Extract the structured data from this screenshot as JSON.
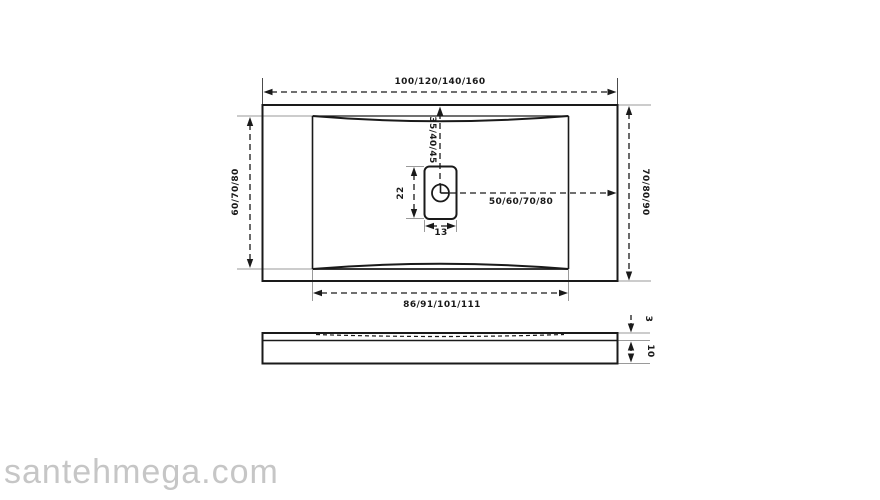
{
  "drawing": {
    "type": "technical-drawing",
    "subject": "rectangular shower tray with central drain, top view and side section",
    "colors": {
      "line": "#1a1a1a",
      "extension_line": "#9a9a9a",
      "watermark": "#c6c6c6",
      "background": "#ffffff"
    },
    "top_view": {
      "overall_width": "100/120/140/160",
      "overall_depth_left": "60/70/80",
      "overall_depth_right": "70/80/90",
      "basin_width": "86/91/101/111",
      "drain_offset_from_top": "35/40/45",
      "drain_offset_from_right": "50/60/70/80",
      "drain_length": "22",
      "drain_width": "13"
    },
    "side_view": {
      "rim_thickness": "3",
      "base_thickness": "10"
    }
  },
  "watermark": {
    "text": "santehmega.com"
  }
}
